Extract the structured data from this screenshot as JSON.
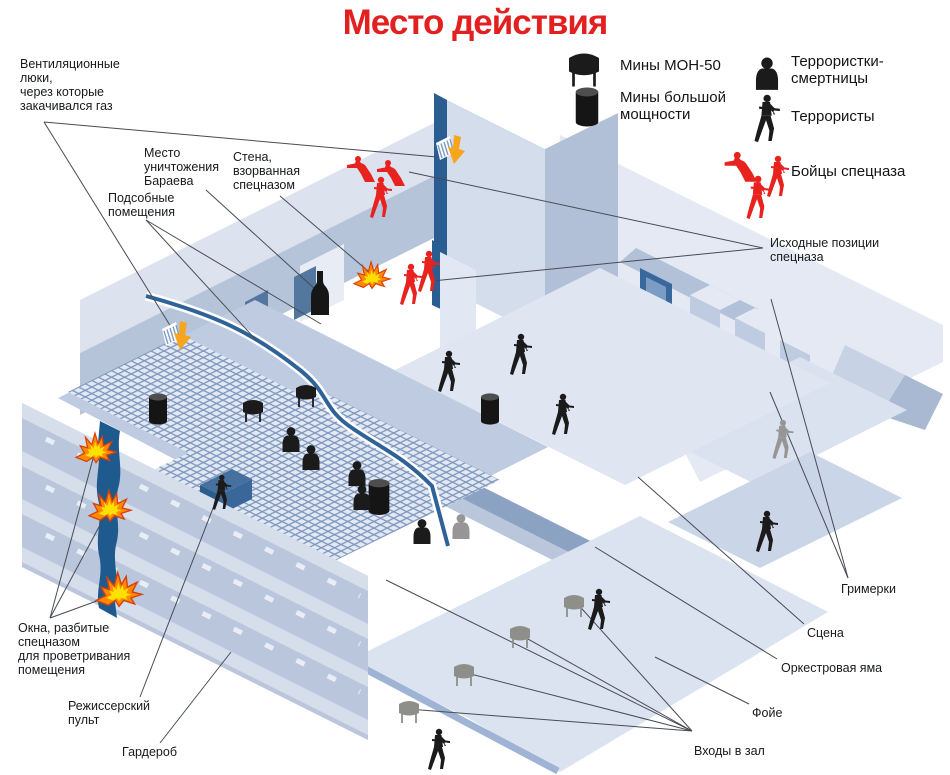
{
  "title": "Место действия",
  "colors": {
    "title_red": "#e32020",
    "spetsnaz_red": "#e8231f",
    "black_figure": "#1b1b1b",
    "gray_figure": "#969696",
    "gray_mine": "#8f8f89",
    "leader_line": "#474c54",
    "label_text": "#17191d",
    "explosion_yellow": "#ffe100",
    "explosion_orange": "#ff8a00",
    "vent_arrow_orange": "#f7a61b",
    "dark_blue_accent": "#2a5d92"
  },
  "legend": {
    "items": [
      {
        "id": "mine-mon50",
        "icon": "mon50",
        "label": "Мины МОН-50",
        "icon_x": 584,
        "icon_y": 70,
        "icon_scale": 1.5,
        "icon_color": "#1b1b1b",
        "label_x": 620,
        "label_y": 57
      },
      {
        "id": "mine-heavy",
        "icon": "heavy",
        "label": "Мины большой\nмощности",
        "icon_x": 587,
        "icon_y": 107,
        "icon_scale": 1.25,
        "icon_color": "#1b1b1b",
        "label_x": 620,
        "label_y": 89
      },
      {
        "id": "female-bomber",
        "icon": "bust",
        "label": "Террористки-\nсмертницы",
        "icon_x": 767,
        "icon_y": 73,
        "icon_scale": 1.3,
        "icon_color": "#1b1b1b",
        "label_x": 791,
        "label_y": 53
      },
      {
        "id": "terrorist",
        "icon": "man",
        "label": "Террористы",
        "icon_x": 766,
        "icon_y": 118,
        "icon_scale": 1.15,
        "icon_color": "#1b1b1b",
        "label_x": 791,
        "label_y": 108
      },
      {
        "id": "spetsnaz",
        "icon": "group",
        "label": "Бойцы спецназа",
        "icon_x": 760,
        "icon_y": 178,
        "icon_scale": 1,
        "icon_color": "#e8231f",
        "label_x": 791,
        "label_y": 163,
        "figures": [
          {
            "pose": "crouch",
            "dx": -17,
            "dy": -10,
            "s": 1.15
          },
          {
            "pose": "man",
            "dx": 17,
            "dy": -2,
            "s": 1.0
          },
          {
            "pose": "man",
            "dx": -3,
            "dy": 19,
            "s": 1.05
          }
        ]
      }
    ]
  },
  "annotations": [
    {
      "id": "vent-hatches",
      "lines": "Вентиляционные\nлюки,\nчерез которые\nзакачивался газ",
      "x": 20,
      "y": 57,
      "anchor": [
        44,
        122
      ],
      "targets": [
        [
          437,
          157
        ],
        [
          171,
          327
        ]
      ]
    },
    {
      "id": "baraev-spot",
      "lines": "Место\nуничтожения\nБараева",
      "x": 144,
      "y": 146,
      "anchor": [
        206,
        190
      ],
      "targets": [
        [
          316,
          290
        ]
      ]
    },
    {
      "id": "blown-wall",
      "lines": "Стена,\nвзорванная\nспецназом",
      "x": 233,
      "y": 150,
      "anchor": [
        280,
        196
      ],
      "targets": [
        [
          368,
          271
        ]
      ]
    },
    {
      "id": "utility-rooms",
      "lines": "Подсобные\nпомещения",
      "x": 108,
      "y": 191,
      "anchor": [
        146,
        220
      ],
      "targets": [
        [
          257,
          341
        ],
        [
          321,
          324
        ]
      ]
    },
    {
      "id": "broken-windows",
      "lines": "Окна, разбитые\nспецназом\nдля проветривания\nпомещения",
      "x": 18,
      "y": 621,
      "anchor": [
        50,
        618
      ],
      "targets": [
        [
          94,
          455
        ],
        [
          107,
          512
        ],
        [
          116,
          594
        ]
      ]
    },
    {
      "id": "director-console",
      "lines": "Режиссерский\nпульт",
      "x": 68,
      "y": 699,
      "anchor": [
        140,
        697
      ],
      "targets": [
        [
          215,
          503
        ]
      ]
    },
    {
      "id": "cloakroom",
      "lines": "Гардероб",
      "x": 122,
      "y": 745,
      "anchor": [
        160,
        743
      ],
      "targets": [
        [
          231,
          652
        ]
      ]
    },
    {
      "id": "spetsnaz-positions",
      "lines": "Исходные позиции\nспецназа",
      "x": 770,
      "y": 236,
      "anchor": [
        763,
        248
      ],
      "targets": [
        [
          409,
          172
        ],
        [
          432,
          281
        ]
      ]
    },
    {
      "id": "dressing-rooms",
      "lines": "Гримерки",
      "x": 841,
      "y": 582,
      "anchor": [
        848,
        578
      ],
      "targets": [
        [
          771,
          299
        ],
        [
          770,
          392
        ]
      ]
    },
    {
      "id": "stage-label",
      "lines": "Сцена",
      "x": 807,
      "y": 626,
      "anchor": [
        804,
        624
      ],
      "targets": [
        [
          638,
          477
        ]
      ]
    },
    {
      "id": "orchestra-pit",
      "lines": "Оркестровая яма",
      "x": 781,
      "y": 661,
      "anchor": [
        777,
        659
      ],
      "targets": [
        [
          595,
          547
        ]
      ]
    },
    {
      "id": "foyer-label",
      "lines": "Фойе",
      "x": 752,
      "y": 706,
      "anchor": [
        749,
        704
      ],
      "targets": [
        [
          655,
          657
        ]
      ]
    },
    {
      "id": "hall-entrances",
      "lines": "Входы в зал",
      "x": 694,
      "y": 744,
      "anchor": [
        692,
        731
      ],
      "targets": [
        [
          574,
          600
        ],
        [
          519,
          634
        ],
        [
          463,
          672
        ],
        [
          408,
          709
        ],
        [
          386,
          580
        ]
      ]
    }
  ],
  "markers": {
    "explosions": [
      {
        "x": 372,
        "y": 277,
        "s": 0.95
      },
      {
        "x": 96,
        "y": 450,
        "s": 1.05
      },
      {
        "x": 110,
        "y": 508,
        "s": 1.1
      },
      {
        "x": 119,
        "y": 592,
        "s": 1.2
      }
    ],
    "vent_arrows": [
      {
        "x": 452,
        "y": 155,
        "s": 1
      },
      {
        "x": 178,
        "y": 341,
        "s": 1
      }
    ],
    "bottles": [
      {
        "x": 320,
        "y": 293,
        "s": 1
      }
    ],
    "heavy_mines": [
      {
        "x": 158,
        "y": 409,
        "s": 1
      },
      {
        "x": 490,
        "y": 409,
        "s": 1
      },
      {
        "x": 379,
        "y": 497,
        "s": 1.15
      }
    ],
    "mon50_black": [
      {
        "x": 253,
        "y": 411,
        "s": 1
      },
      {
        "x": 306,
        "y": 396,
        "s": 1
      }
    ],
    "mon50_gray": [
      {
        "x": 574,
        "y": 606,
        "s": 1
      },
      {
        "x": 520,
        "y": 637,
        "s": 1
      },
      {
        "x": 464,
        "y": 675,
        "s": 1
      },
      {
        "x": 409,
        "y": 712,
        "s": 1
      }
    ],
    "bombers_black": [
      {
        "x": 291,
        "y": 439,
        "s": 1
      },
      {
        "x": 311,
        "y": 457,
        "s": 1
      },
      {
        "x": 357,
        "y": 473,
        "s": 1
      },
      {
        "x": 362,
        "y": 497,
        "s": 1
      },
      {
        "x": 422,
        "y": 531,
        "s": 1
      }
    ],
    "bombers_gray": [
      {
        "x": 461,
        "y": 526,
        "s": 1
      }
    ],
    "terrorists_black": [
      {
        "x": 448,
        "y": 371,
        "s": 1
      },
      {
        "x": 520,
        "y": 354,
        "s": 1
      },
      {
        "x": 562,
        "y": 414,
        "s": 1
      },
      {
        "x": 766,
        "y": 531,
        "s": 1
      },
      {
        "x": 598,
        "y": 609,
        "s": 1
      },
      {
        "x": 438,
        "y": 749,
        "s": 1
      },
      {
        "x": 221,
        "y": 492,
        "s": 0.85
      }
    ],
    "terrorists_gray": [
      {
        "x": 782,
        "y": 439,
        "s": 0.95
      }
    ],
    "spetsnaz_stand": [
      {
        "x": 380,
        "y": 197,
        "s": 1
      },
      {
        "x": 410,
        "y": 284,
        "s": 1
      },
      {
        "x": 428,
        "y": 271,
        "s": 1
      }
    ],
    "spetsnaz_crouch": [
      {
        "x": 363,
        "y": 170,
        "s": 1
      },
      {
        "x": 393,
        "y": 174,
        "s": 1
      }
    ]
  }
}
